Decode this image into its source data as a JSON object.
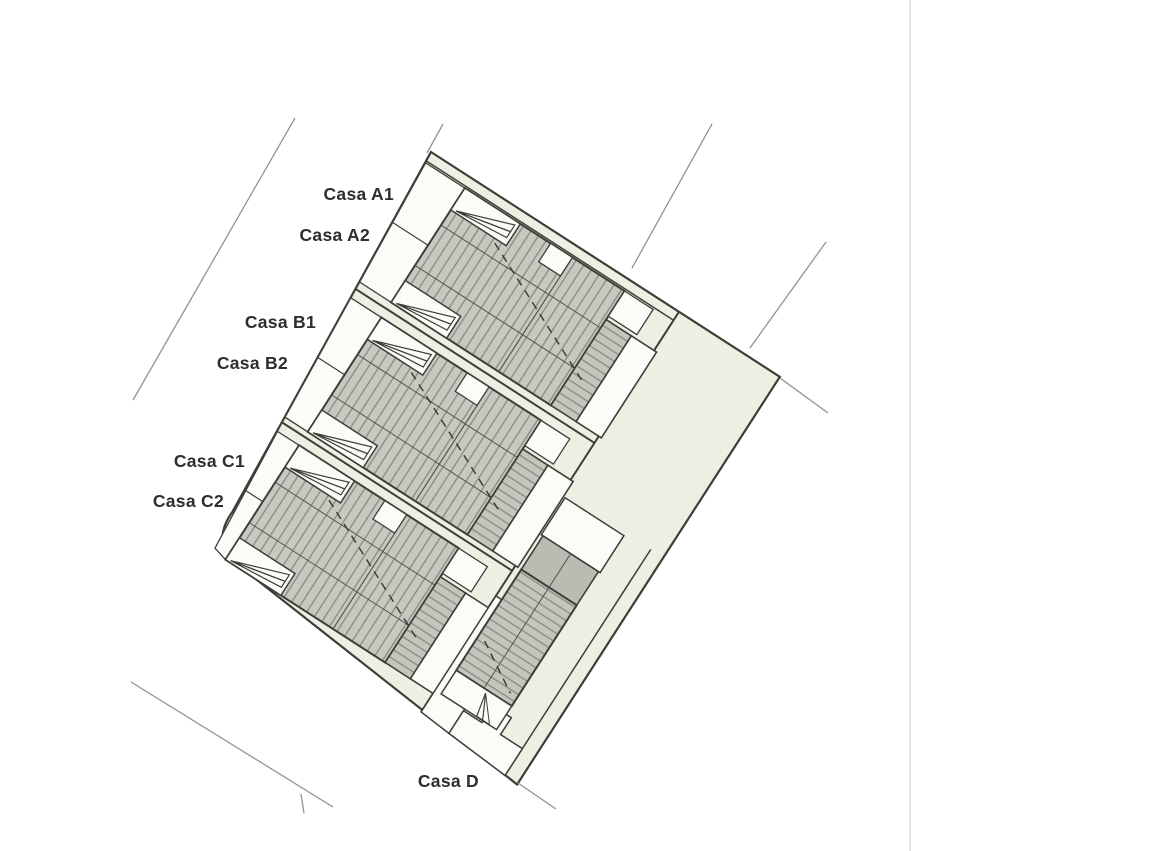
{
  "page": {
    "background": "#ffffff",
    "right_column_divider_color": "#e3e3e3"
  },
  "site_plan": {
    "type": "residential-masterplan",
    "houses": [
      {
        "id": "A1",
        "label": "Casa A1"
      },
      {
        "id": "A2",
        "label": "Casa A2"
      },
      {
        "id": "B1",
        "label": "Casa B1"
      },
      {
        "id": "B2",
        "label": "Casa B2"
      },
      {
        "id": "C1",
        "label": "Casa C1"
      },
      {
        "id": "C2",
        "label": "Casa C2"
      },
      {
        "id": "D",
        "label": "Casa D"
      }
    ],
    "colors": {
      "plot_green": "#ecf0e3",
      "roof_fill": "#c9c8c0",
      "roof_stripe": "#8e8d85",
      "roof_solid": "#bcbbb3",
      "outline": "#3e3e39",
      "white_area": "#fbfbf8",
      "survey_line": "#929292",
      "label_text": "#2e2e2e"
    }
  }
}
